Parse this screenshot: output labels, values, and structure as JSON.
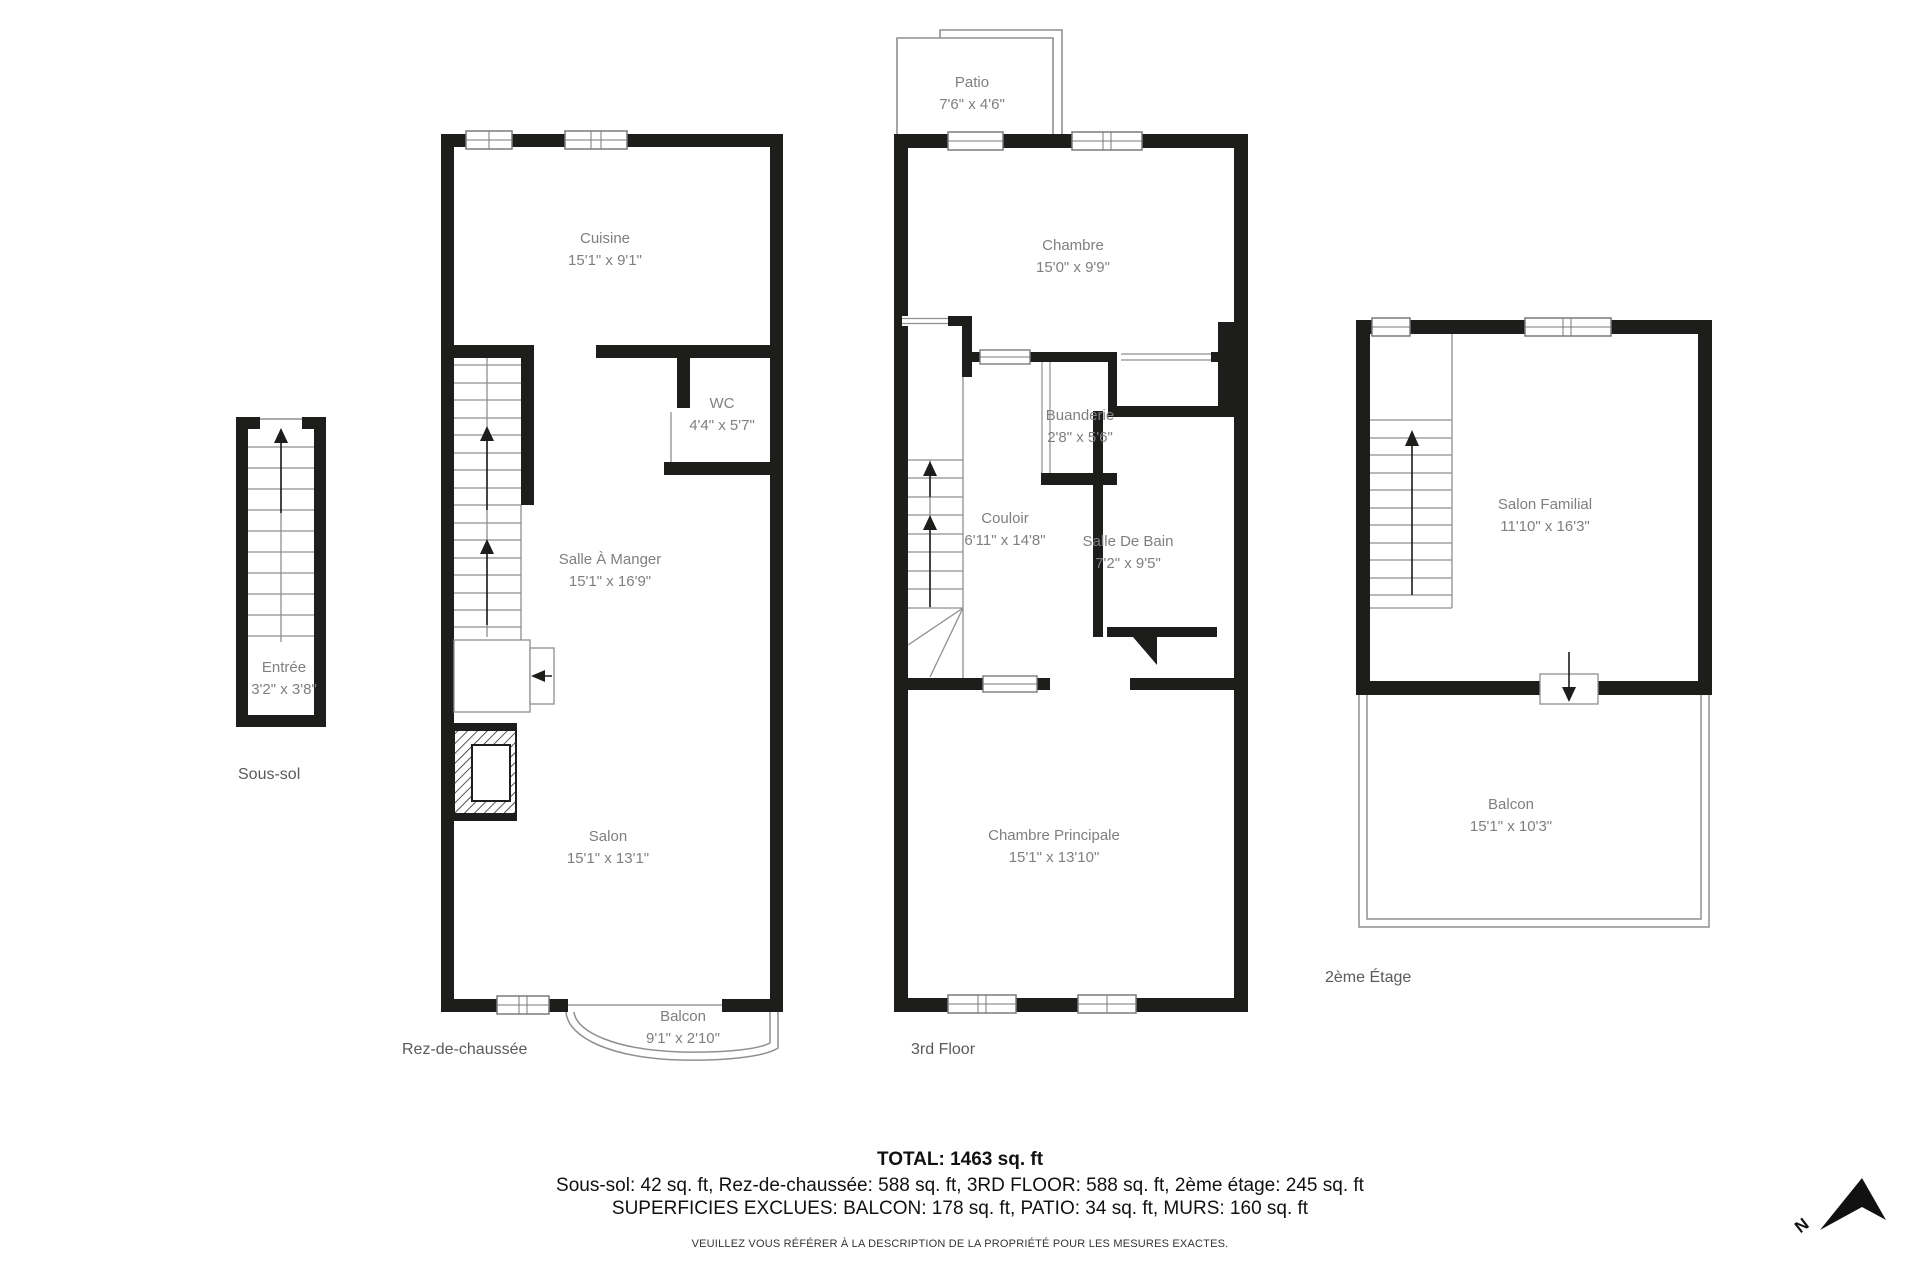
{
  "floors": {
    "sous_sol": {
      "label": "Sous-sol",
      "rooms": {
        "entree": {
          "name": "Entrée",
          "dims": "3'2\" x 3'8\""
        }
      }
    },
    "rdc": {
      "label": "Rez-de-chaussée",
      "rooms": {
        "cuisine": {
          "name": "Cuisine",
          "dims": "15'1\" x 9'1\""
        },
        "wc": {
          "name": "WC",
          "dims": "4'4\" x 5'7\""
        },
        "salle_a_manger": {
          "name": "Salle À Manger",
          "dims": "15'1\" x 16'9\""
        },
        "salon": {
          "name": "Salon",
          "dims": "15'1\" x 13'1\""
        },
        "balcon": {
          "name": "Balcon",
          "dims": "9'1\" x 2'10\""
        }
      }
    },
    "third": {
      "label": "3rd Floor",
      "rooms": {
        "patio": {
          "name": "Patio",
          "dims": "7'6\" x 4'6\""
        },
        "chambre": {
          "name": "Chambre",
          "dims": "15'0\" x 9'9\""
        },
        "buanderie": {
          "name": "Buanderie",
          "dims": "2'8\" x 5'6\""
        },
        "couloir": {
          "name": "Couloir",
          "dims": "6'11\" x 14'8\""
        },
        "salle_de_bain": {
          "name": "Salle De Bain",
          "dims": "7'2\" x 9'5\""
        },
        "chambre_principale": {
          "name": "Chambre Principale",
          "dims": "15'1\" x 13'10\""
        }
      }
    },
    "etage2": {
      "label": "2ème Étage",
      "rooms": {
        "salon_familial": {
          "name": "Salon Familial",
          "dims": "11'10\" x 16'3\""
        },
        "balcon": {
          "name": "Balcon",
          "dims": "15'1\" x 10'3\""
        }
      }
    }
  },
  "summary": {
    "total": "TOTAL: 1463 sq. ft",
    "by_floor": "Sous-sol: 42 sq. ft, Rez-de-chaussée: 588 sq. ft, 3RD FLOOR: 588 sq. ft, 2ème étage: 245 sq. ft",
    "excluded": "SUPERFICIES EXCLUES: BALCON: 178 sq. ft, PATIO: 34 sq. ft, MURS: 160 sq. ft",
    "disclaimer": "VEUILLEZ VOUS RÉFÉRER À LA DESCRIPTION DE LA PROPRIÉTÉ POUR LES MESURES EXACTES."
  },
  "compass": {
    "label": "N"
  },
  "colors": {
    "wall": "#1d1d1b",
    "thin_line": "#8f8f8f",
    "room_text": "#7f7f7f",
    "floor_text": "#5a5a5a",
    "summary_text": "#111111"
  }
}
